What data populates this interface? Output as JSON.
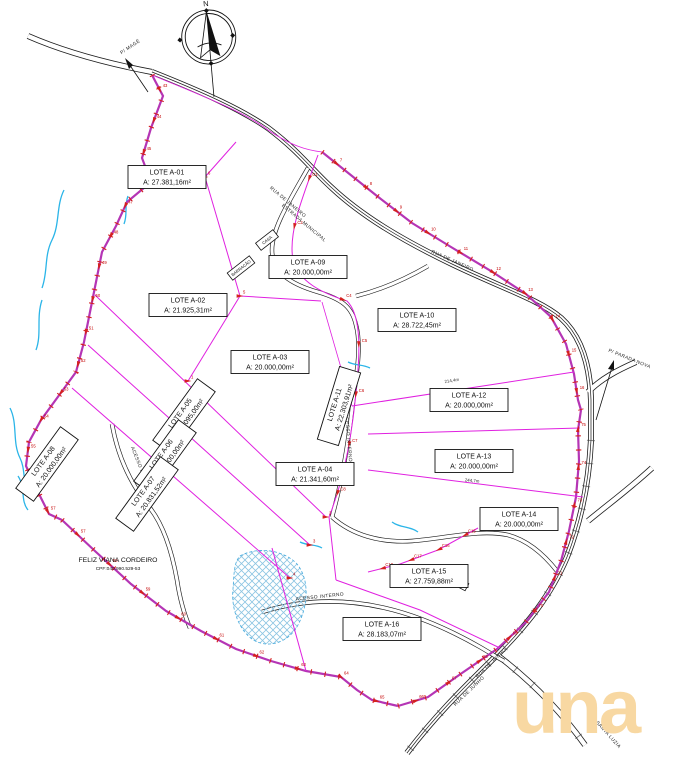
{
  "compass": {
    "north_label": "N"
  },
  "owner": {
    "name": "FELIZ VIANA CORDEIRO",
    "cpf": "CPF:040.990.529-53"
  },
  "watermark": {
    "text": "una",
    "color": "#f8d8a2"
  },
  "lots": [
    {
      "id": "A-01",
      "name": "LOTE A-01",
      "area": "A: 27.381,16m²"
    },
    {
      "id": "A-02",
      "name": "LOTE A-02",
      "area": "A: 21.925,31m²"
    },
    {
      "id": "A-03",
      "name": "LOTE A-03",
      "area": "A: 20.000,00m²"
    },
    {
      "id": "A-04",
      "name": "LOTE A-04",
      "area": "A: 21.341,60m²"
    },
    {
      "id": "A-05",
      "name": "LOTE A-05",
      "area": "A: 21.095,00m²"
    },
    {
      "id": "A-06",
      "name": "LOTE A-06",
      "area": "A: 20.000,00m²"
    },
    {
      "id": "A-07",
      "name": "LOTE A-07",
      "area": "A: 20.831,52m²"
    },
    {
      "id": "A-08",
      "name": "LOTE A-08",
      "area": "A: 20.000,00m²"
    },
    {
      "id": "A-09",
      "name": "LOTE A-09",
      "area": "A: 20.000,00m²"
    },
    {
      "id": "A-10",
      "name": "LOTE A-10",
      "area": "A: 28.722,45m²"
    },
    {
      "id": "A-11",
      "name": "LOTE A-11",
      "area": "A: 22.303,91m²"
    },
    {
      "id": "A-12",
      "name": "LOTE A-12",
      "area": "A: 20.000,00m²"
    },
    {
      "id": "A-13",
      "name": "LOTE A-13",
      "area": "A: 20.000,00m²"
    },
    {
      "id": "A-14",
      "name": "LOTE A-14",
      "area": "A: 20.000,00m²"
    },
    {
      "id": "A-15",
      "name": "LOTE A-15",
      "area": "A: 27.759,88m²"
    },
    {
      "id": "A-16",
      "name": "LOTE A-16",
      "area": "A: 28.183,07m²"
    }
  ],
  "roads": {
    "rua_janeiro": "RUA DE JANEIRO",
    "estrada": "ESTRADA MUNICIPAL",
    "rua_junho": "RUA DE JUNHO",
    "acesso": "ACESSO INTERNO"
  },
  "arrows": {
    "northwest": "P/ MAGÉ",
    "east": "P/ PARADA NOVA",
    "southeast": "P/ SANTA LUZIA"
  },
  "buildings": {
    "casa": "CASA",
    "barracao": "BARRACÃO",
    "casa2": "CASA"
  },
  "dimensions": {
    "d1": "244,7m",
    "d2": "214,4m"
  },
  "point_labels": {
    "west": [
      "43",
      "44",
      "45",
      "46",
      "47",
      "48",
      "49",
      "50",
      "51",
      "52",
      "53",
      "54",
      "55",
      "56",
      "57"
    ],
    "northeast": [
      "7",
      "8",
      "9",
      "10",
      "11",
      "12",
      "13",
      "14",
      "15",
      "16"
    ],
    "southeast": [
      "66",
      "67",
      "68",
      "69",
      "70",
      "71",
      "72",
      "73",
      "74",
      "75"
    ],
    "southwest": [
      "57",
      "58",
      "59",
      "60",
      "61",
      "62",
      "63",
      "64",
      "65"
    ],
    "center": [
      "C1",
      "C2",
      "C3",
      "C4",
      "C5",
      "C6",
      "C7",
      "C8"
    ],
    "group_c": [
      "C15",
      "C16",
      "C17",
      "C18"
    ],
    "nodes": [
      "1",
      "2",
      "3",
      "4",
      "5",
      "6",
      "7"
    ]
  },
  "colors": {
    "boundary": "#b535b5",
    "lot_line": "#e020e0",
    "marker": "#d42020",
    "water": "#2bb5e8",
    "road": "#1c1c1c",
    "watermark": "#f8d8a2"
  }
}
